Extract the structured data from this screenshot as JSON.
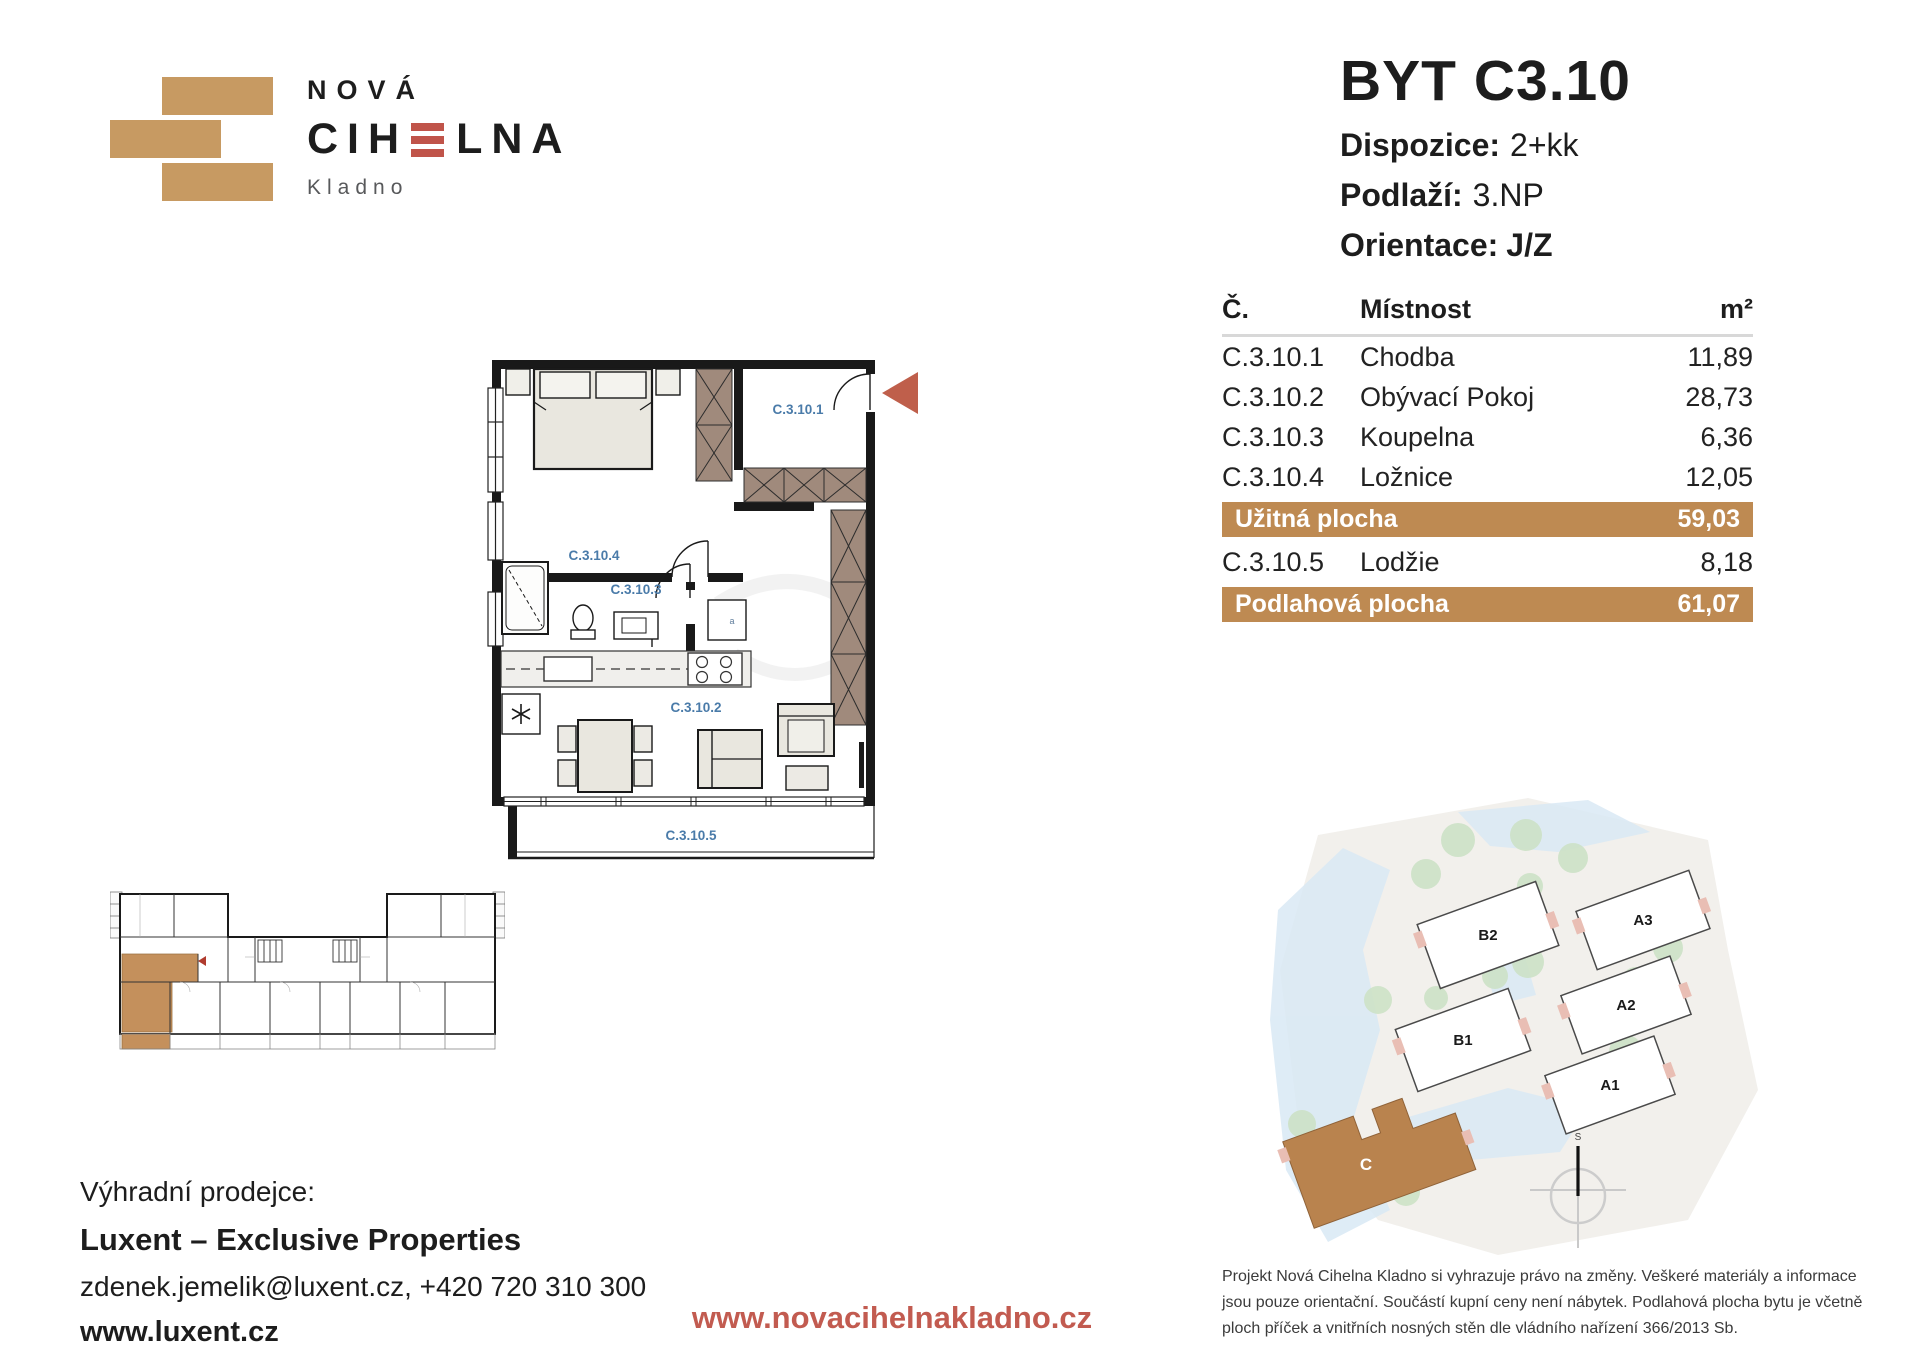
{
  "logo": {
    "line1": "NOVÁ",
    "line2_pre": "CIH",
    "line2_post": "LNA",
    "line3": "Kladno"
  },
  "header": {
    "title": "BYT C3.10",
    "specs": [
      {
        "label": "Dispozice:",
        "value": "2+kk"
      },
      {
        "label": "Podlaží:",
        "value": "3.NP"
      },
      {
        "label": "Orientace:",
        "value": "J/Z"
      }
    ]
  },
  "table": {
    "columns": [
      "Č.",
      "Místnost",
      "m²"
    ],
    "rooms": [
      {
        "code": "C.3.10.1",
        "name": "Chodba",
        "area": "11,89"
      },
      {
        "code": "C.3.10.2",
        "name": "Obývací Pokoj",
        "area": "28,73"
      },
      {
        "code": "C.3.10.3",
        "name": "Koupelna",
        "area": "6,36"
      },
      {
        "code": "C.3.10.4",
        "name": "Ložnice",
        "area": "12,05"
      }
    ],
    "usable": {
      "label": "Užitná plocha",
      "value": "59,03"
    },
    "loggia_row": {
      "code": "C.3.10.5",
      "name": "Lodžie",
      "area": "8,18"
    },
    "total": {
      "label": "Podlahová plocha",
      "value": "61,07"
    }
  },
  "floorplan": {
    "labels": {
      "hall": "C.3.10.1",
      "living": "C.3.10.2",
      "bath": "C.3.10.3",
      "bedroom": "C.3.10.4",
      "loggia": "C.3.10.5"
    },
    "washer_label": "a"
  },
  "siteplan": {
    "labels": [
      "B2",
      "B1",
      "A3",
      "A2",
      "A1",
      "C"
    ],
    "compass_label": "S"
  },
  "footer": {
    "seller_intro": "Výhradní prodejce:",
    "seller_name": "Luxent – Exclusive Properties",
    "seller_contact": "zdenek.jemelik@luxent.cz, +420 720 310 300",
    "seller_web": "www.luxent.cz",
    "project_web": "www.novacihelnakladno.cz",
    "disclaimer": "Projekt Nová Cihelna Kladno si vyhrazuje právo na změny. Veškeré materiály a informace jsou pouze orientační. Součástí kupní ceny není nábytek. Podlahová plocha bytu je včetně ploch příček a vnitřních nosných stěn dle vládního nařízení 366/2013 Sb."
  },
  "colors": {
    "brand_tan": "#BE8A52",
    "brick_red": "#C0544A",
    "room_label_blue": "#4a7ba9"
  }
}
